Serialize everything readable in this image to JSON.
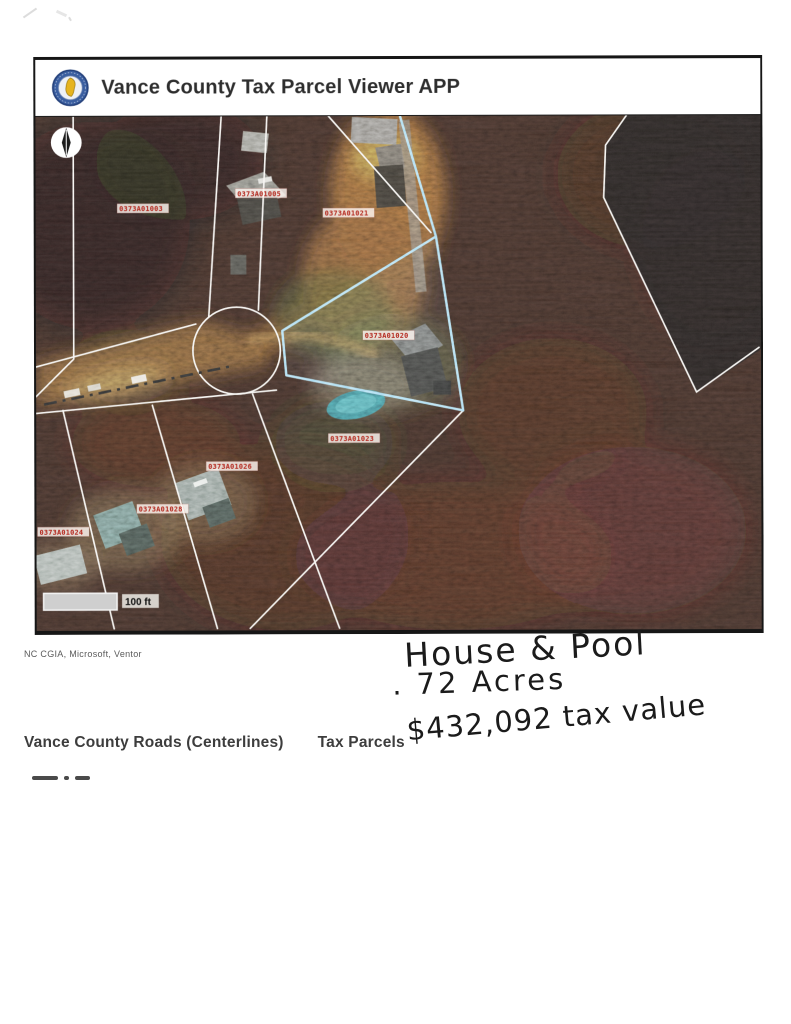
{
  "header": {
    "title": "Vance County Tax Parcel Viewer APP",
    "logo": "vance-county-seal"
  },
  "map": {
    "scale_label": "100 ft",
    "compass": "north-arrow",
    "selected_parcel_color": "#8fd2ee",
    "boundary_color": "#ffffff",
    "parcel_label_color": "#b3261c",
    "parcels": [
      {
        "id": "0373A01003"
      },
      {
        "id": "0373A01005"
      },
      {
        "id": "0373A01021"
      },
      {
        "id": "0373A01020"
      },
      {
        "id": "0373A01023"
      },
      {
        "id": "0373A01026"
      },
      {
        "id": "0373A01028"
      },
      {
        "id": "0373A01024"
      }
    ]
  },
  "attribution": "NC CGIA, Microsoft, Ventor",
  "handwriting": {
    "line1": "House & Pool",
    "line2": ". 72 Acres",
    "line3": "$432,092 tax value"
  },
  "legend": {
    "roads_label": "Vance County Roads (Centerlines)",
    "parcels_label": "Tax Parcels"
  }
}
